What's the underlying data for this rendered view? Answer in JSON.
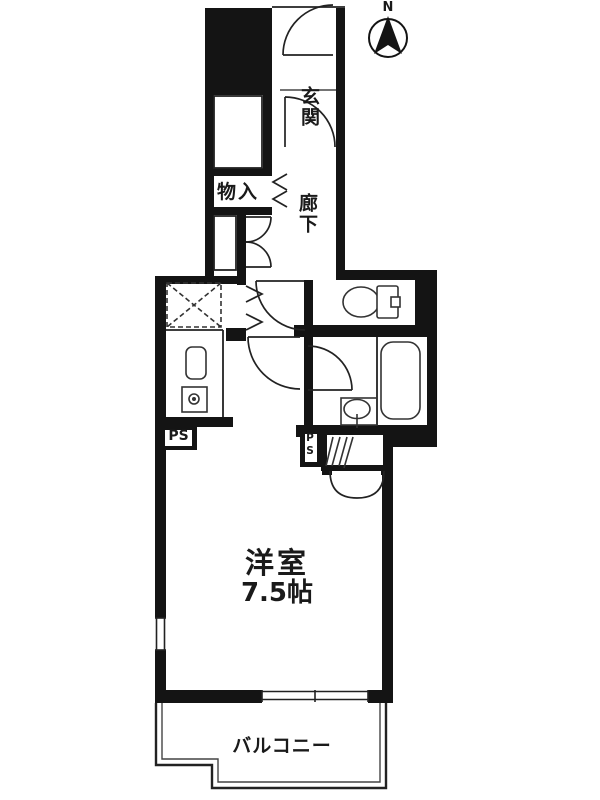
{
  "floorplan": {
    "compass_label": "N",
    "labels": {
      "entrance": "玄関",
      "storage": "物入",
      "hallway": "廊下",
      "western_room": "洋室",
      "western_room_size": "7.5帖",
      "balcony": "バルコニー",
      "pipe_space_kitchen": "PS",
      "pipe_space_bath": "PS"
    },
    "colors": {
      "wall": "#141414",
      "line": "#222222",
      "fixture": "#333333",
      "background": "#ffffff"
    }
  }
}
